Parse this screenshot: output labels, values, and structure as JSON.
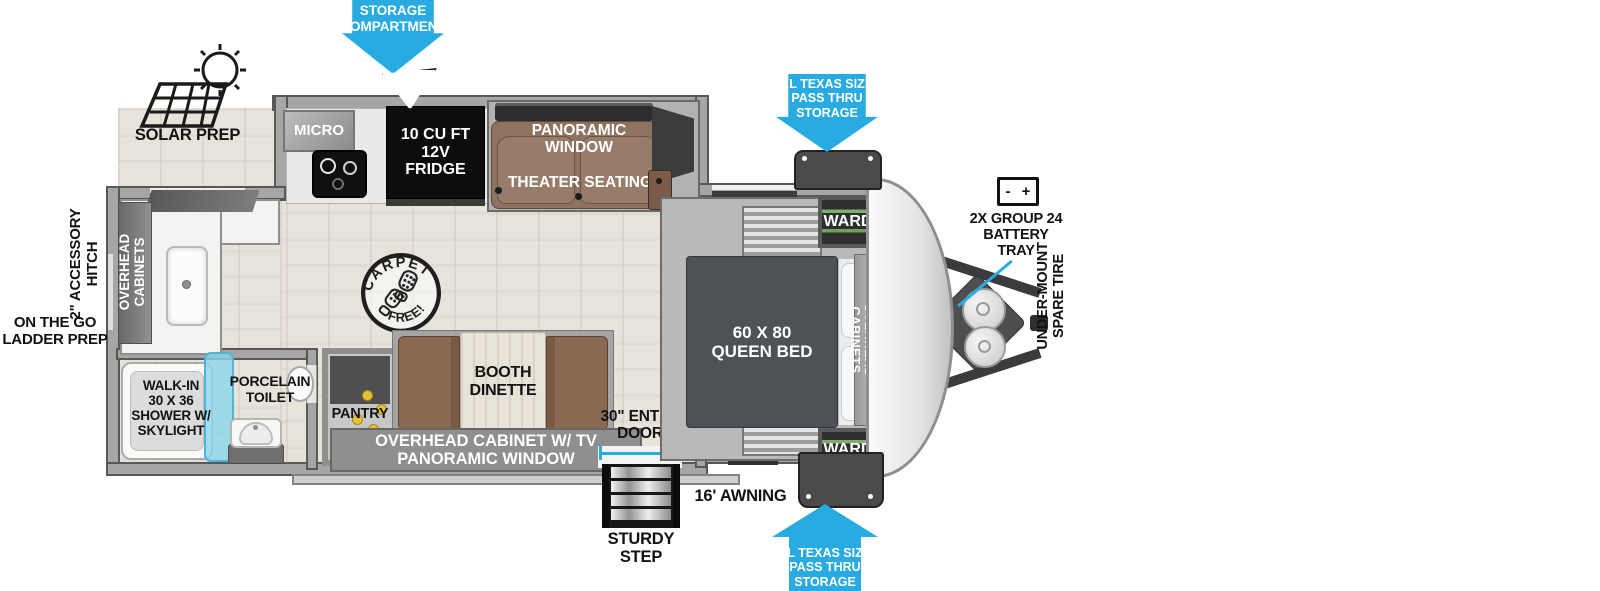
{
  "labels": {
    "solar_prep": "SOLAR PREP",
    "storage_compartment": "STORAGE\nCOMPARTMENT",
    "pass_thru_top": "XL TEXAS SIZE\nPASS THRU\nSTORAGE",
    "pass_thru_bottom": "XL TEXAS SIZE\nPASS THRU\nSTORAGE",
    "battery_tray": "2X GROUP 24\nBATTERY\nTRAY",
    "battery_minus": "-",
    "battery_plus": "+",
    "spare_tire": "UNDER-MOUNT\nSPARE TIRE",
    "accessory_hitch": "2\" ACCESSORY\nHITCH",
    "ladder_prep": "ON THE GO\nLADDER PREP",
    "entry_door": "30\" ENTRY\nDOOR",
    "awning": "16' AWNING",
    "sturdy_step": "STURDY\nSTEP"
  },
  "rooms": {
    "micro": "MICRO",
    "fridge": "10 CU FT\n12V\nFRIDGE",
    "panoramic_window": "PANORAMIC WINDOW",
    "theater_seating": "THEATER SEATING",
    "ward_top": "WARD",
    "ward_bottom": "WARD",
    "overhead_cabinets_bed": "OVERHEAD CABINETS",
    "overhead_cabinets_rear": "OVERHEAD\nCABINETS",
    "queen_bed": "60 X 80\nQUEEN BED",
    "carpet_stamp_top": "CARPET",
    "carpet_stamp_bottom": "FREE!",
    "booth_dinette": "BOOTH\nDINETTE",
    "pantry": "PANTRY",
    "tv_cabinet": "OVERHEAD CABINET W/ TV\nPANORAMIC WINDOW",
    "porcelain_toilet": "PORCELAIN\nTOILET",
    "shower": "WALK-IN\n30 X 36\nSHOWER W/\nSKYLIGHT"
  },
  "colors": {
    "arrow_blue": "#29abe2",
    "shower_glass": "#8ed8ec",
    "sofa_brown": "#8d7360",
    "dinette_brown": "#8a6952",
    "bed_gray": "#4d5257",
    "fridge_black": "#0d0d0d"
  }
}
